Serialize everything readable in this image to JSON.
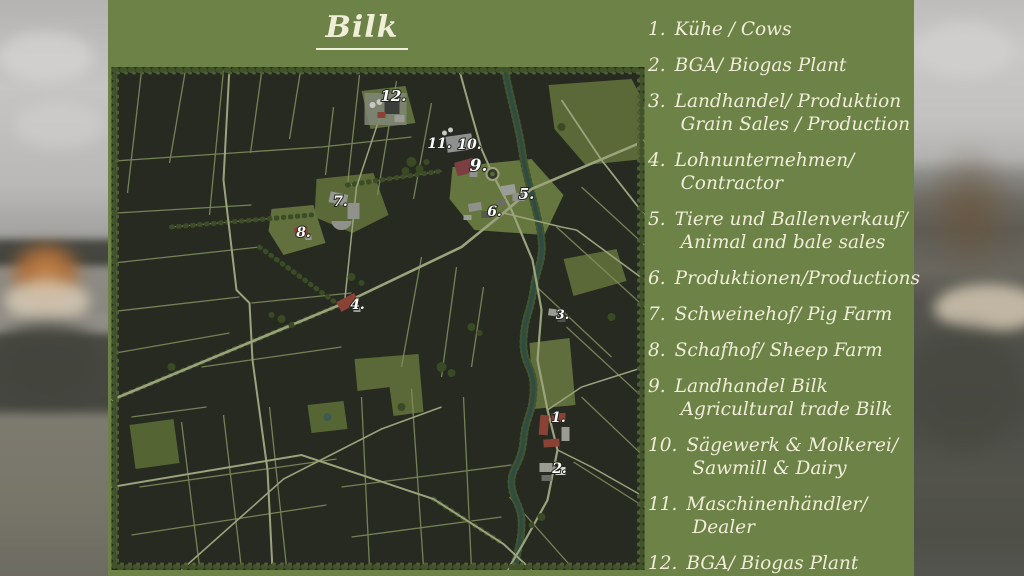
{
  "title": "Bilk",
  "legend": {
    "items": [
      {
        "num": "1.",
        "lines": [
          "Kühe / Cows"
        ]
      },
      {
        "num": "2.",
        "lines": [
          "BGA/ Biogas Plant"
        ]
      },
      {
        "num": "3.",
        "lines": [
          "Landhandel/ Produktion",
          "Grain Sales / Production"
        ]
      },
      {
        "num": "4.",
        "lines": [
          "Lohnunternehmen/",
          "Contractor"
        ]
      },
      {
        "num": "5.",
        "lines": [
          "Tiere und Ballenverkauf/",
          "Animal and bale sales"
        ]
      },
      {
        "num": "6.",
        "lines": [
          "Produktionen/Productions"
        ]
      },
      {
        "num": "7.",
        "lines": [
          "Schweinehof/ Pig Farm"
        ]
      },
      {
        "num": "8.",
        "lines": [
          "Schafhof/ Sheep Farm"
        ]
      },
      {
        "num": "9.",
        "lines": [
          "Landhandel Bilk",
          "Agricultural trade Bilk"
        ]
      },
      {
        "num": "10.",
        "lines": [
          "Sägewerk & Molkerei/",
          "Sawmill & Dairy"
        ]
      },
      {
        "num": "11.",
        "lines": [
          "Maschinenhändler/",
          "Dealer"
        ]
      },
      {
        "num": "12.",
        "lines": [
          "BGA/ Biogas Plant"
        ]
      }
    ]
  },
  "map": {
    "markers": [
      {
        "id": "12",
        "label": "12.",
        "x": 282,
        "y": 34,
        "s": 15
      },
      {
        "id": "11",
        "label": "11.",
        "x": 328,
        "y": 81,
        "s": 14
      },
      {
        "id": "10",
        "label": "10.",
        "x": 358,
        "y": 82,
        "s": 14
      },
      {
        "id": "9",
        "label": "9.",
        "x": 367,
        "y": 104,
        "s": 17
      },
      {
        "id": "5",
        "label": "5.",
        "x": 415,
        "y": 132,
        "s": 15
      },
      {
        "id": "6",
        "label": "6.",
        "x": 383,
        "y": 149,
        "s": 14
      },
      {
        "id": "7",
        "label": "7.",
        "x": 229,
        "y": 139,
        "s": 14
      },
      {
        "id": "8",
        "label": "8.",
        "x": 192,
        "y": 170,
        "s": 14
      },
      {
        "id": "4",
        "label": "4.",
        "x": 246,
        "y": 242,
        "s": 14
      },
      {
        "id": "3",
        "label": "3.",
        "x": 451,
        "y": 252,
        "s": 13
      },
      {
        "id": "1",
        "label": "1.",
        "x": 447,
        "y": 355,
        "s": 14
      },
      {
        "id": "2",
        "label": "2.",
        "x": 448,
        "y": 406,
        "s": 14
      }
    ]
  },
  "colors": {
    "panel_green": "#6c8247",
    "text_cream": "#f0edd8",
    "map_field_dark": "#272a21",
    "map_line_green": "#83925f",
    "grass_green": "#5a6937",
    "tree_green": "#3c4c26",
    "river_teal": "#2e4b44",
    "road": "#9ba37d",
    "marker_white": "#ffffff",
    "roof_red": "#8a4136",
    "roof_gray": "#9a9c98"
  }
}
